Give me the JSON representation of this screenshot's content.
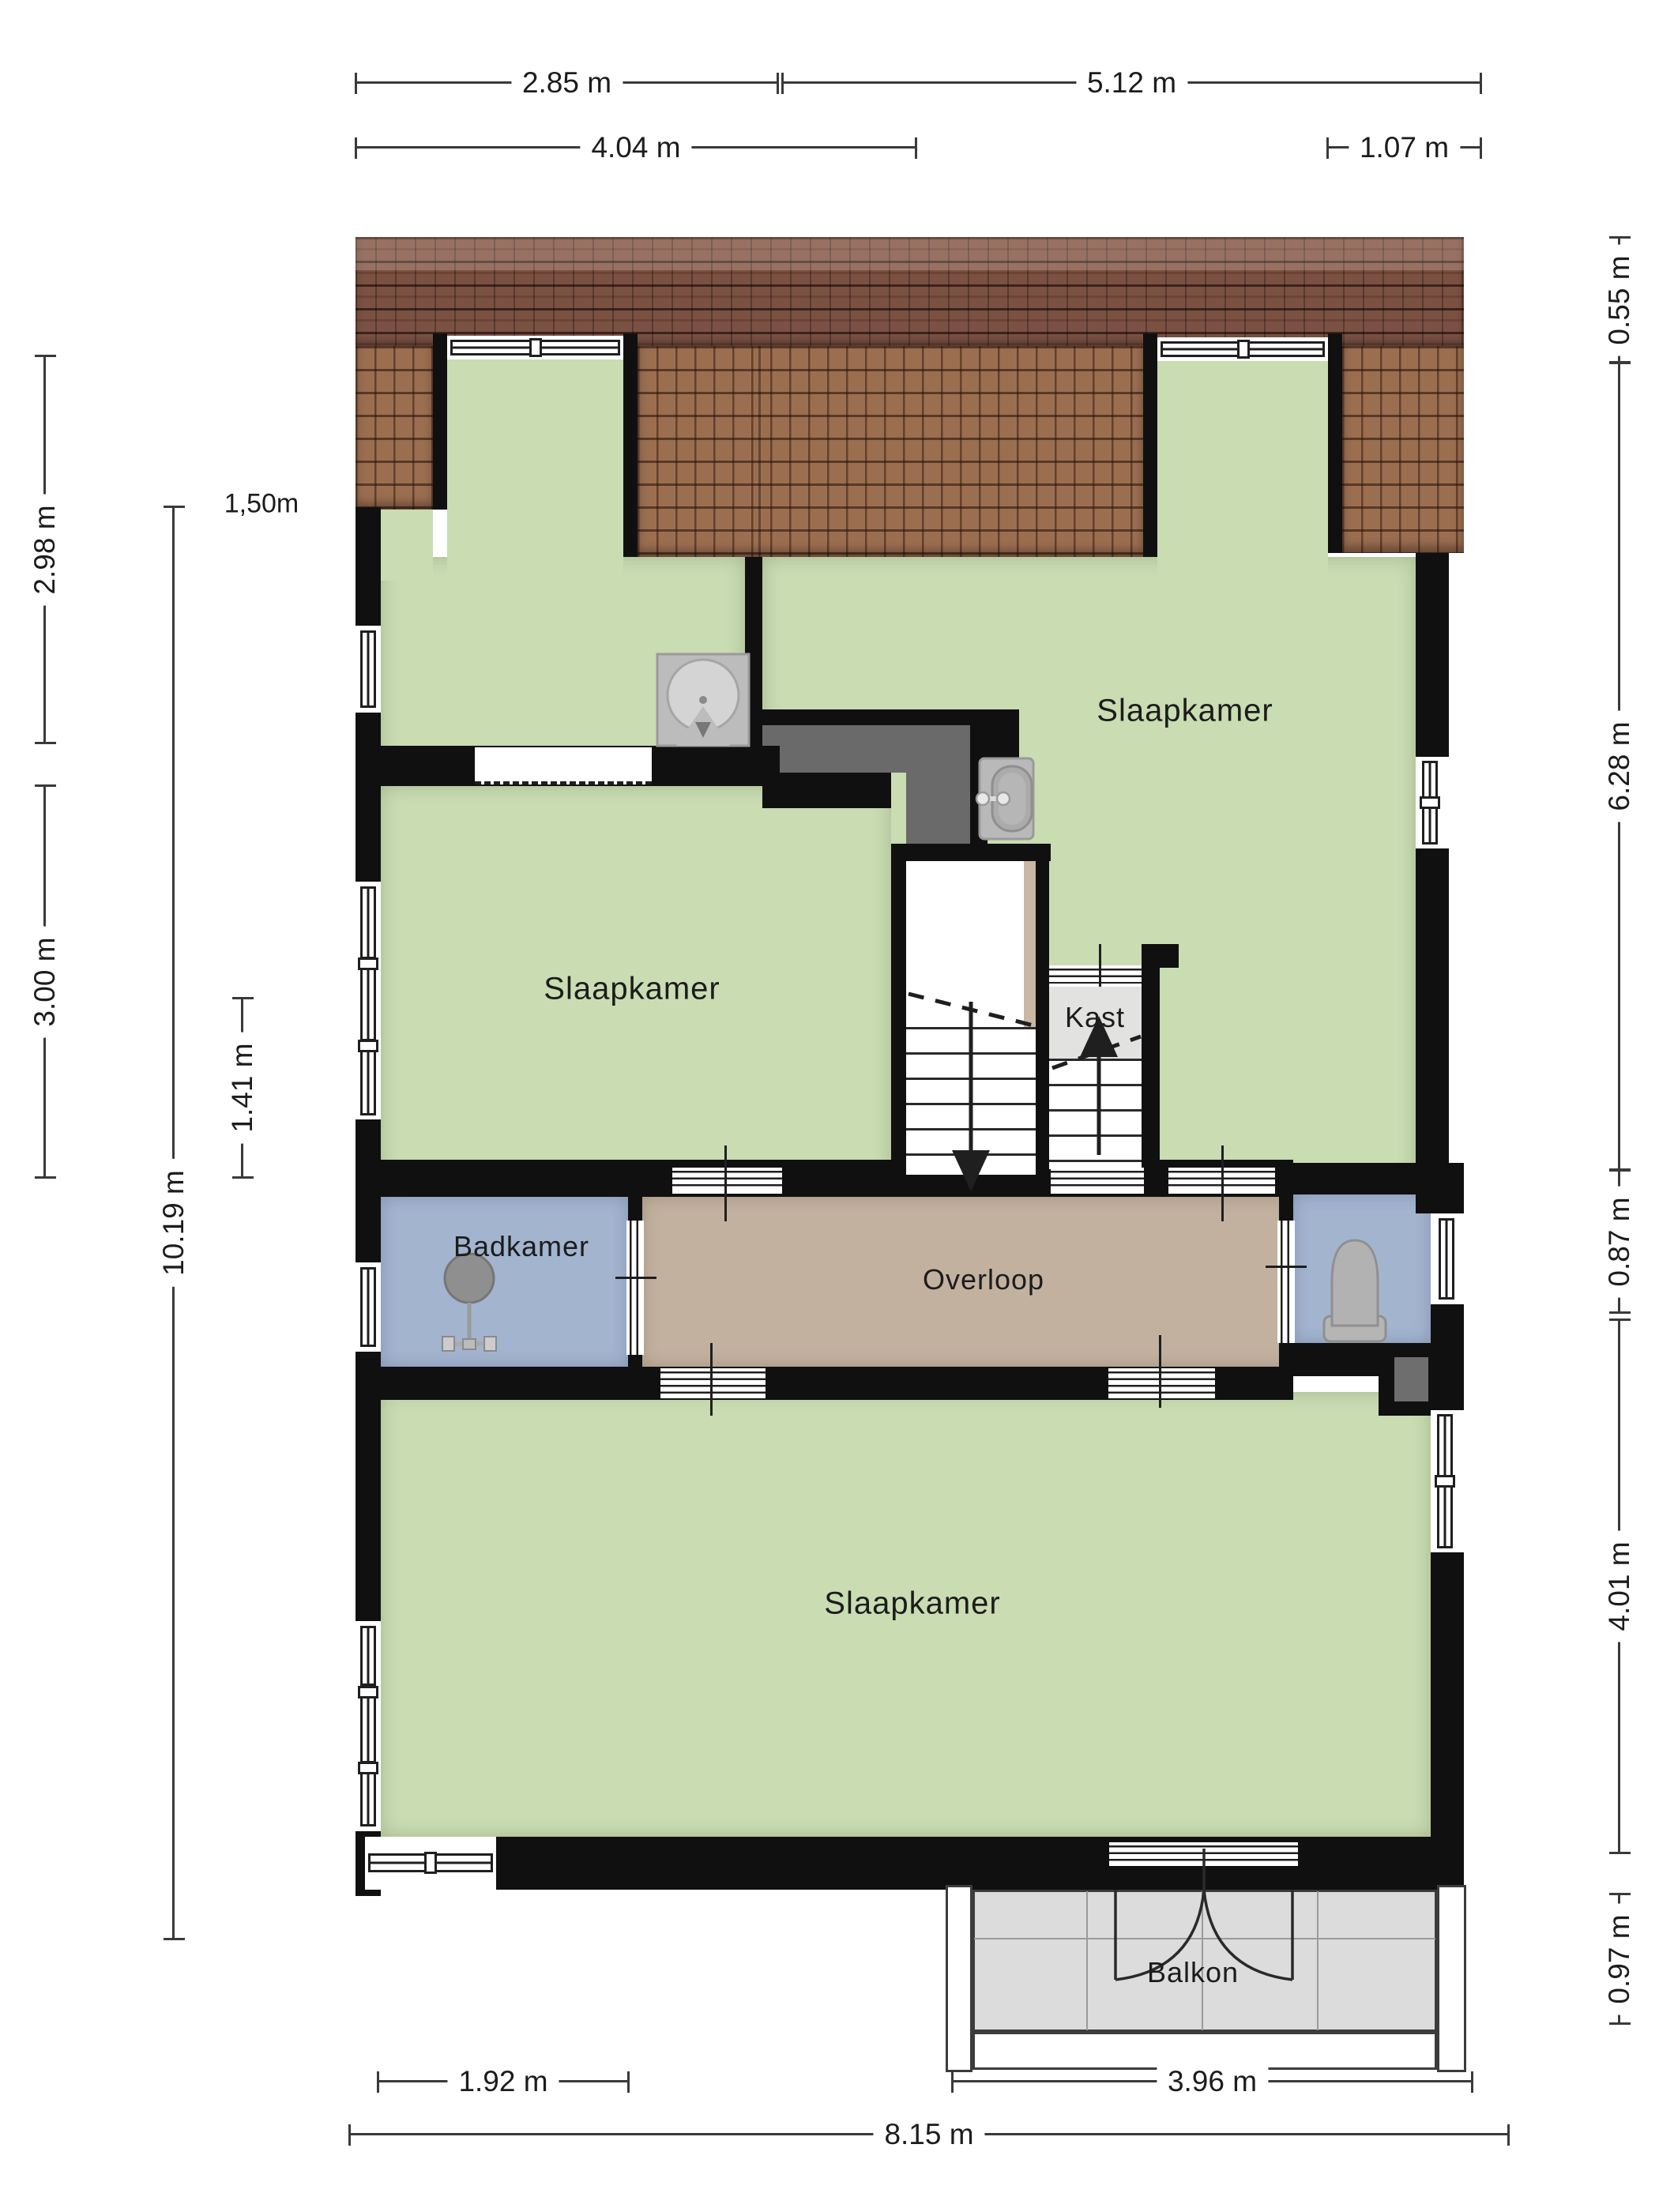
{
  "plan": {
    "rooms": [
      {
        "id": "bedroom-top",
        "label": "Slaapkamer"
      },
      {
        "id": "bedroom-middle",
        "label": "Slaapkamer"
      },
      {
        "id": "bedroom-bottom",
        "label": "Slaapkamer"
      },
      {
        "id": "bathroom",
        "label": "Badkamer"
      },
      {
        "id": "landing",
        "label": "Overloop"
      },
      {
        "id": "closet",
        "label": "Kast"
      },
      {
        "id": "balcony",
        "label": "Balkon"
      }
    ],
    "annotation": "1,50m"
  },
  "dimensions": {
    "top": [
      {
        "label": "2.85 m"
      },
      {
        "label": "5.12 m"
      },
      {
        "label": "4.04 m"
      },
      {
        "label": "1.07 m"
      }
    ],
    "left": [
      {
        "label": "2.98 m"
      },
      {
        "label": "3.00 m"
      },
      {
        "label": "10.19 m"
      },
      {
        "label": "1.41 m"
      }
    ],
    "right": [
      {
        "label": "0.55 m"
      },
      {
        "label": "6.28 m"
      },
      {
        "label": "0.87 m"
      },
      {
        "label": "4.01 m"
      },
      {
        "label": "0.97 m"
      }
    ],
    "bottom": [
      {
        "label": "1.92 m"
      },
      {
        "label": "3.96 m"
      },
      {
        "label": "8.15 m"
      }
    ]
  },
  "icons": [
    "sink-icon",
    "washbasin-icon",
    "shower-icon",
    "toilet-icon",
    "arrow-down-icon",
    "arrow-up-icon"
  ],
  "colors": {
    "room_green": "#c9dcb2",
    "wet_blue": "#a3b4cf",
    "hall_tan": "#c3b1a0",
    "closet_grey": "#e2e2e0",
    "void_grey": "#6a6a6a",
    "balcony_grey": "#dcdcdc",
    "roof_dark": "#7b5143",
    "roof_light": "#9c6e50",
    "wall_black": "#101010",
    "dim_line": "#3a3a3a",
    "text": "#1c1c1c"
  }
}
